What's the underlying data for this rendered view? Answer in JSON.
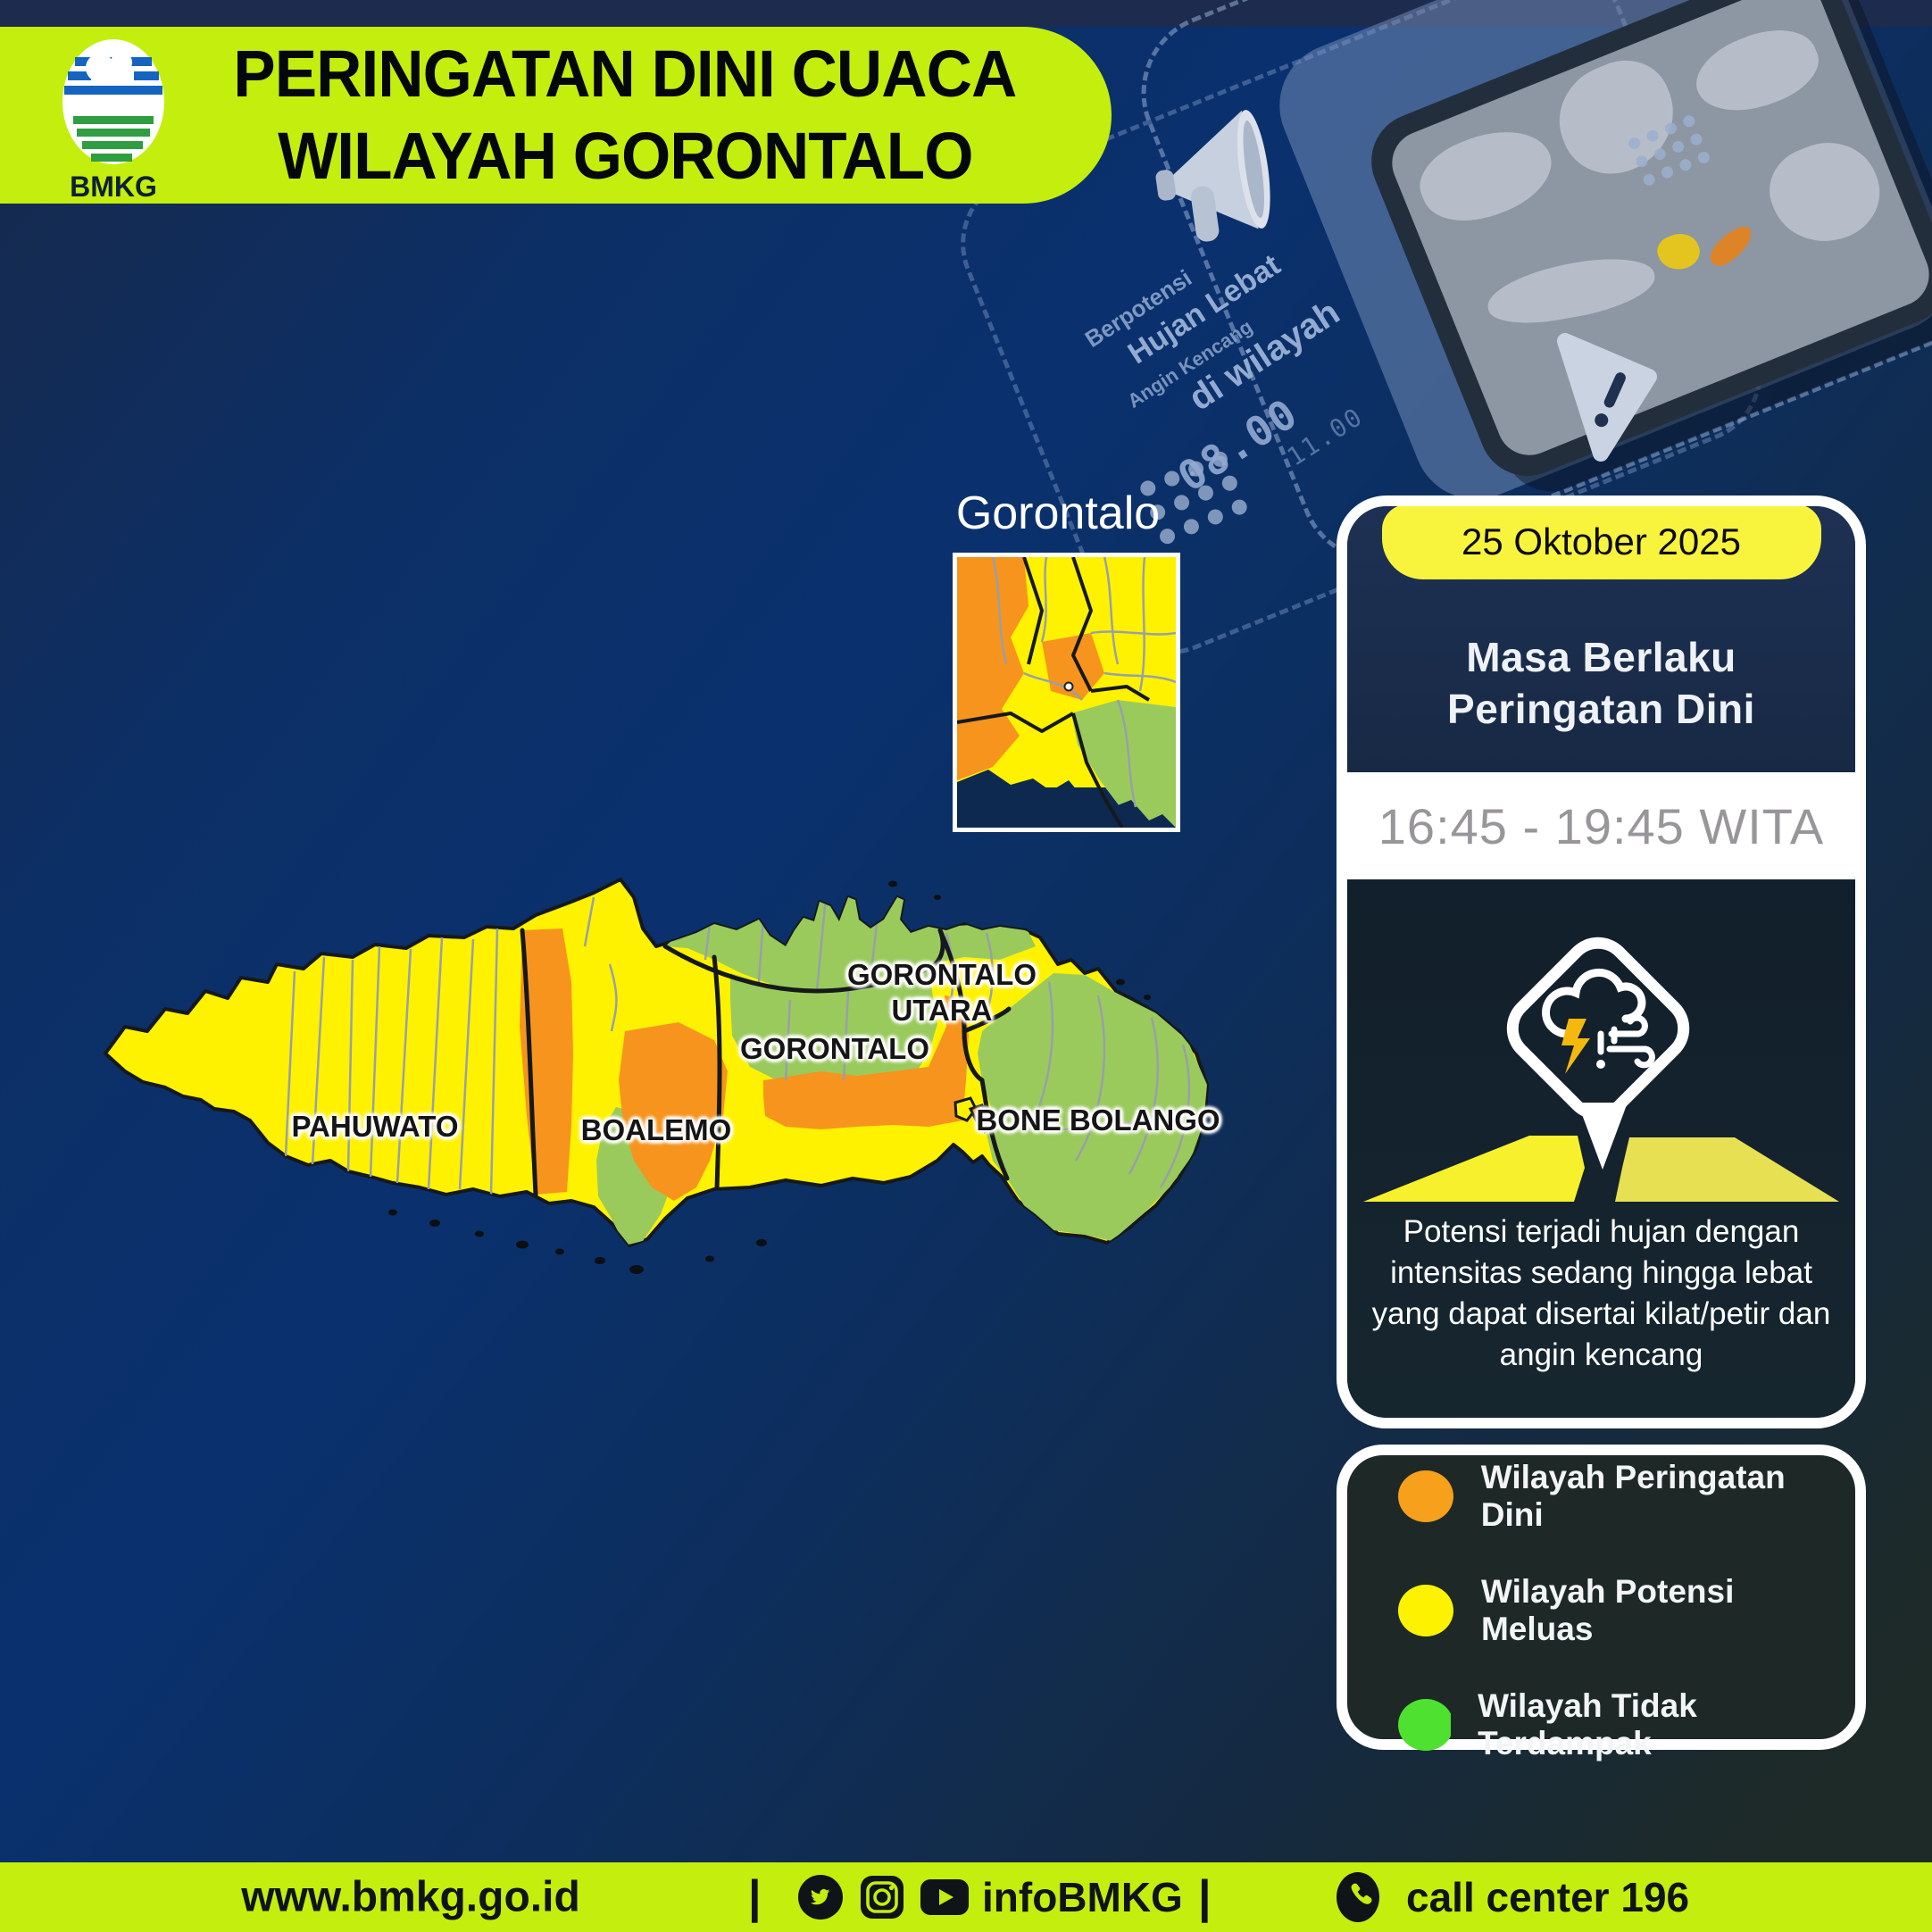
{
  "header": {
    "top_bar_color": "#1d2b4e",
    "banner_color": "#c4ee0e",
    "title_line1": "PERINGATAN DINI CUACA",
    "title_line2": "WILAYAH GORONTALO",
    "logo_text": "BMKG"
  },
  "illustration": {
    "label_lines": [
      "Berpotensi",
      "Hujan Lebat",
      "Angin Kencang",
      "di wilayah"
    ],
    "clock_primary": "08.00",
    "clock_secondary": "11.00"
  },
  "inset_map": {
    "title": "Gorontalo"
  },
  "map": {
    "region_labels": [
      {
        "text": "PAHUWATO"
      },
      {
        "text": "BOALEMO"
      },
      {
        "text": "GORONTALO"
      },
      {
        "text": "GORONTALO UTARA"
      },
      {
        "text": "BONE BOLANGO"
      }
    ],
    "colors": {
      "warning_orange": "#f7941e",
      "potential_yellow": "#fff200",
      "unaffected_green": "#9aca5c",
      "sea_navy": "#0d2950",
      "boundary_black": "#15191d",
      "subdivision_gray": "#98a0a8"
    }
  },
  "panel": {
    "date": "25 Oktober 2025",
    "validity_line1": "Masa Berlaku",
    "validity_line2": "Peringatan Dini",
    "time_range": "16:45 - 19:45 WITA",
    "description": "Potensi terjadi hujan dengan intensitas sedang hingga lebat yang dapat disertai kilat/petir dan angin kencang"
  },
  "legend": {
    "items": [
      {
        "label": "Wilayah Peringatan Dini",
        "color": "#f6a01b"
      },
      {
        "label": "Wilayah Potensi Meluas",
        "color": "#fdf300"
      },
      {
        "label": "Wilayah Tidak Terdampak",
        "color": "#4fe12f"
      }
    ]
  },
  "footer": {
    "bar_color": "#c4ee0e",
    "website": "www.bmkg.go.id",
    "separator": "|",
    "social_handle": "infoBMKG",
    "call_center": "call center 196"
  }
}
